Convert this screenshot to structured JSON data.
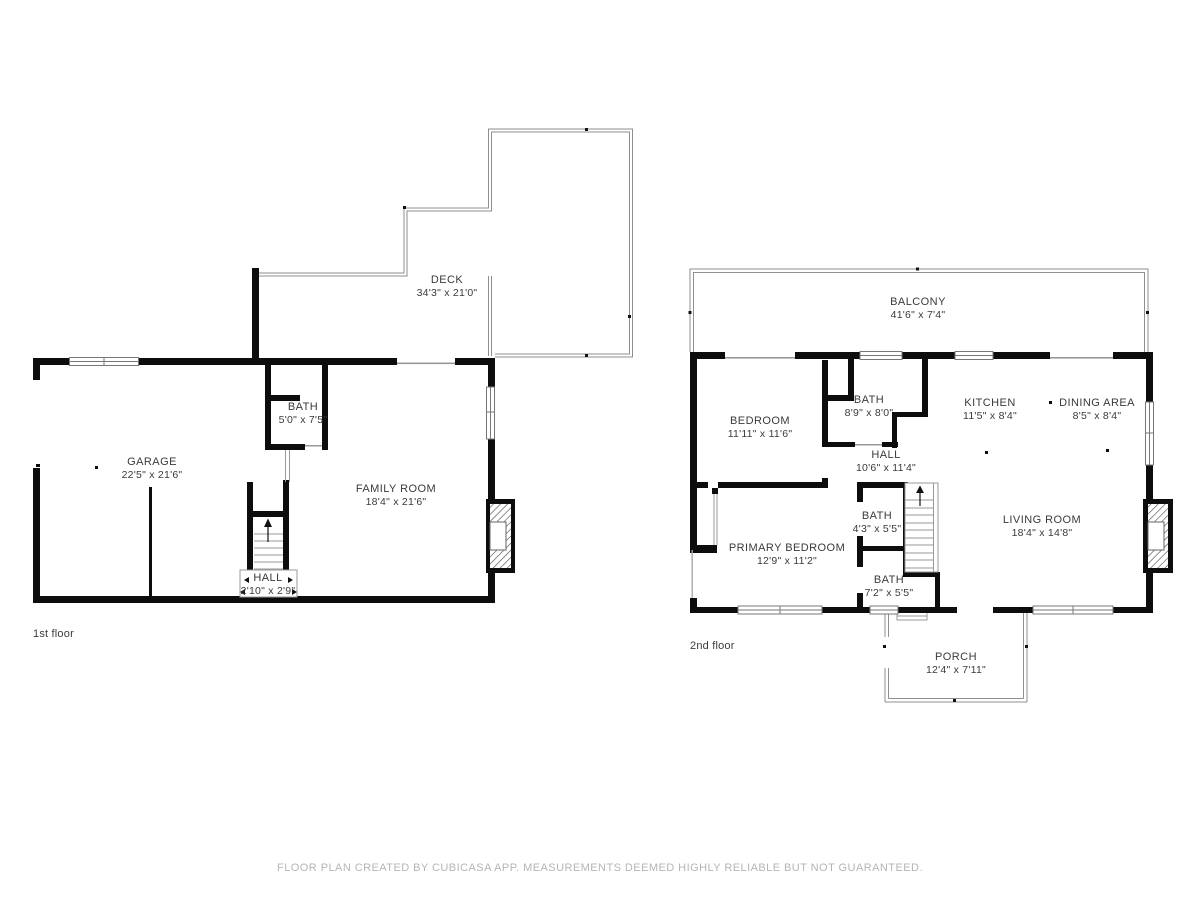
{
  "footer": "FLOOR PLAN CREATED BY CUBICASA APP. MEASUREMENTS DEEMED HIGHLY RELIABLE BUT NOT GUARANTEED.",
  "floors": [
    {
      "label": "1st floor",
      "rooms": [
        {
          "name": "DECK",
          "dims": "34'3\" x 21'0\""
        },
        {
          "name": "BATH",
          "dims": "5'0\" x 7'5\""
        },
        {
          "name": "GARAGE",
          "dims": "22'5\" x 21'6\""
        },
        {
          "name": "FAMILY ROOM",
          "dims": "18'4\" x 21'6\""
        },
        {
          "name": "HALL",
          "dims": "2'10\" x 2'9\""
        }
      ]
    },
    {
      "label": "2nd floor",
      "rooms": [
        {
          "name": "BALCONY",
          "dims": "41'6\" x 7'4\""
        },
        {
          "name": "BEDROOM",
          "dims": "11'11\" x 11'6\""
        },
        {
          "name": "BATH",
          "dims": "8'9\" x 8'0\""
        },
        {
          "name": "KITCHEN",
          "dims": "11'5\" x 8'4\""
        },
        {
          "name": "DINING AREA",
          "dims": "8'5\" x 8'4\""
        },
        {
          "name": "HALL",
          "dims": "10'6\" x 11'4\""
        },
        {
          "name": "BATH",
          "dims": "4'3\" x 5'5\""
        },
        {
          "name": "PRIMARY BEDROOM",
          "dims": "12'9\" x 11'2\""
        },
        {
          "name": "BATH",
          "dims": "7'2\" x 5'5\""
        },
        {
          "name": "LIVING ROOM",
          "dims": "18'4\" x 14'8\""
        },
        {
          "name": "PORCH",
          "dims": "12'4\" x 7'11\""
        }
      ]
    }
  ]
}
